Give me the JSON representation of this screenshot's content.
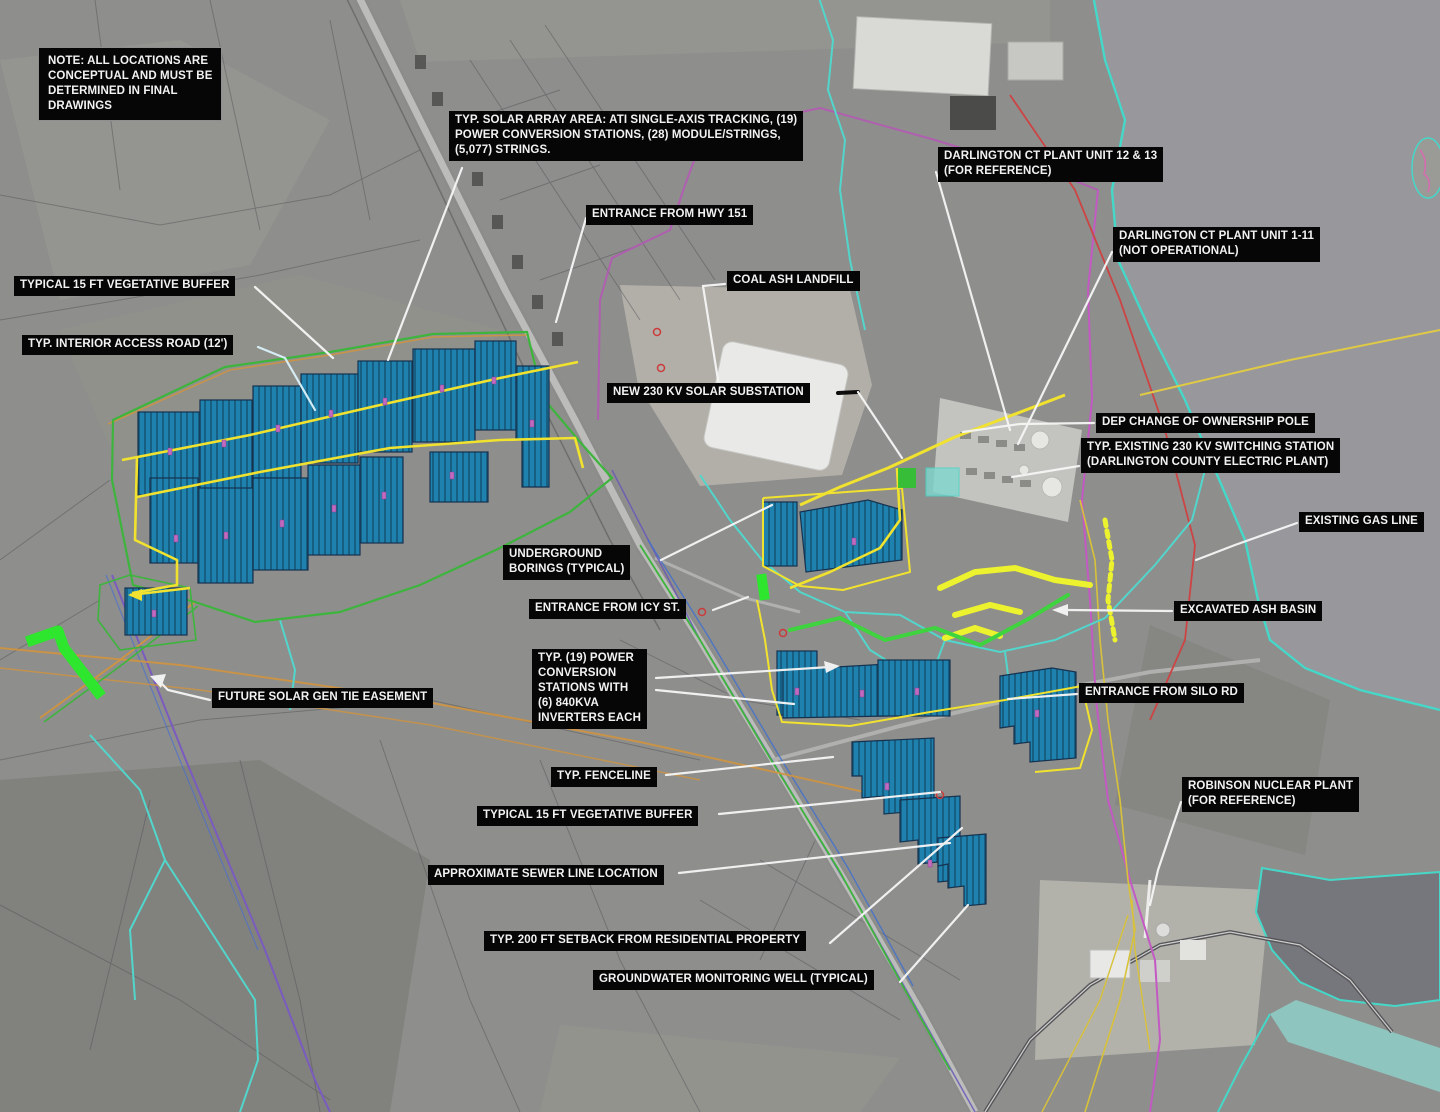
{
  "map": {
    "type": "annotated-satellite-site-plan",
    "subject": "Solar project conceptual site plan at Darlington County Electric Plant / Robinson area"
  },
  "colors": {
    "solar_array_fill": "#1f81ae",
    "solar_array_stripe": "#11506f",
    "field_access_road_yellow": "#f0e22e",
    "site_boundary_green": "#3db53d",
    "easement_highlight_green": "#2ee62e",
    "stream_cyan": "#52d6cc",
    "property_line_magenta": "#c35ac3",
    "gas_line_red": "#cc4444",
    "gen_tie_purple": "#7a5bbf",
    "utility_orange": "#cf9440",
    "leader_white": "#f5f5f5",
    "label_background": "#060606",
    "label_text": "#f2f2f2",
    "lake_gray": "#97979c",
    "dark_lake_gray": "#76777c"
  },
  "labels": [
    {
      "id": "note",
      "text": "NOTE: ALL LOCATIONS ARE\nCONCEPTUAL AND MUST BE\nDETERMINED IN FINAL\nDRAWINGS"
    },
    {
      "id": "solar-array-area",
      "text": "TYP. SOLAR ARRAY AREA: ATI SINGLE-AXIS TRACKING, (19)\nPOWER CONVERSION STATIONS, (28) MODULE/STRINGS,\n(5,077) STRINGS."
    },
    {
      "id": "entrance-hwy-151",
      "text": "ENTRANCE FROM HWY 151"
    },
    {
      "id": "darlington-unit-12-13",
      "text": "DARLINGTON CT PLANT UNIT 12 & 13\n(FOR REFERENCE)"
    },
    {
      "id": "darlington-unit-1-11",
      "text": "DARLINGTON CT PLANT UNIT 1-11\n(NOT OPERATIONAL)"
    },
    {
      "id": "coal-ash-landfill",
      "text": "COAL ASH LANDFILL"
    },
    {
      "id": "vegetative-buffer-north",
      "text": "TYPICAL 15 FT VEGETATIVE BUFFER"
    },
    {
      "id": "interior-access-road",
      "text": "TYP. INTERIOR ACCESS ROAD (12')"
    },
    {
      "id": "new-solar-substation",
      "text": "NEW  230 KV SOLAR SUBSTATION"
    },
    {
      "id": "dep-ownership-pole",
      "text": "DEP CHANGE OF OWNERSHIP POLE"
    },
    {
      "id": "switching-station",
      "text": "TYP. EXISTING 230 KV SWITCHING STATION\n(DARLINGTON COUNTY ELECTRIC PLANT)"
    },
    {
      "id": "existing-gas-line",
      "text": "EXISTING GAS LINE"
    },
    {
      "id": "underground-borings",
      "text": "UNDERGROUND\nBORINGS (TYPICAL)"
    },
    {
      "id": "entrance-icy-st",
      "text": "ENTRANCE FROM ICY ST."
    },
    {
      "id": "excavated-ash-basin",
      "text": "EXCAVATED ASH BASIN"
    },
    {
      "id": "power-conversion-stations",
      "text": "TYP. (19)  POWER\nCONVERSION\nSTATIONS WITH\n(6) 840KVA\nINVERTERS EACH"
    },
    {
      "id": "entrance-silo-rd",
      "text": "ENTRANCE FROM SILO RD"
    },
    {
      "id": "future-gen-tie-easement",
      "text": "FUTURE  SOLAR GEN TIE EASEMENT"
    },
    {
      "id": "fenceline",
      "text": "TYP. FENCELINE"
    },
    {
      "id": "vegetative-buffer-south",
      "text": "TYPICAL 15 FT VEGETATIVE BUFFER"
    },
    {
      "id": "sewer-line",
      "text": "APPROXIMATE SEWER LINE LOCATION"
    },
    {
      "id": "robinson-nuclear-plant",
      "text": "ROBINSON NUCLEAR PLANT\n(FOR REFERENCE)"
    },
    {
      "id": "residential-setback",
      "text": "TYP. 200 FT SETBACK FROM RESIDENTIAL PROPERTY"
    },
    {
      "id": "groundwater-well",
      "text": "GROUNDWATER MONITORING WELL (TYPICAL)"
    }
  ]
}
